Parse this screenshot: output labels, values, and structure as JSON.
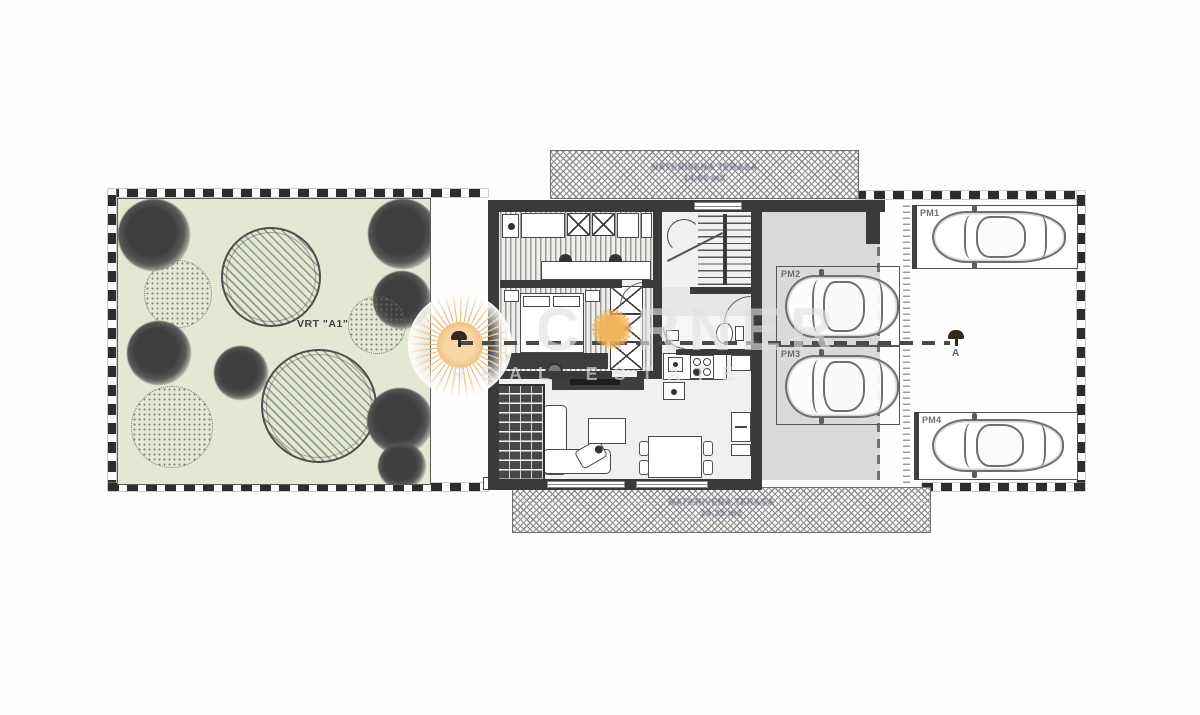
{
  "garden": {
    "label": "VRT \"A1\""
  },
  "terrace_top": {
    "line1": "NATKRIVENA TERASA",
    "line2": "14,60 m2"
  },
  "terrace_bottom": {
    "line1": "NATKRIVENA TERASA",
    "line2": "24,35 m2"
  },
  "parking": {
    "spaces": [
      {
        "label": "PM1"
      },
      {
        "label": "PM2"
      },
      {
        "label": "PM3"
      },
      {
        "label": "PM4"
      }
    ]
  },
  "section_marker": {
    "label": "A"
  },
  "watermark": {
    "brand_prefix": "C",
    "brand_suffix": "RNER",
    "subtitle": "REAL ESTATE"
  },
  "colors": {
    "wall": "#3a3a3a",
    "garden_green": "#e2e8d4",
    "slab_gray": "#d9d9d9",
    "sun_orange": "#f0bd7e",
    "boundary": "#2d2d2d"
  }
}
